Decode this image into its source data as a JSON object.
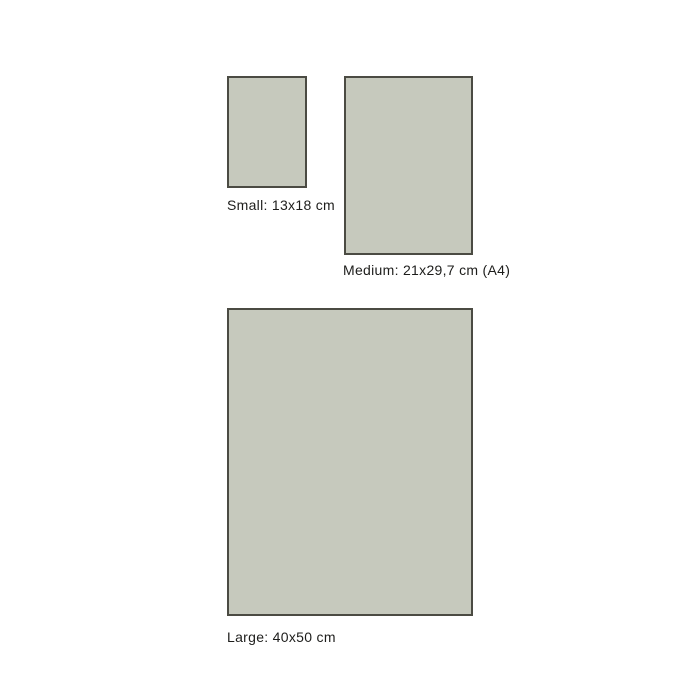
{
  "diagram": {
    "title": "print-size-guide",
    "colors": {
      "rect_fill": "#c6c9bd",
      "rect_border": "#4b4b43",
      "label_text": "#1d1d1b",
      "background": "#ffffff"
    },
    "sizes": [
      {
        "id": "small",
        "label": "Small: 13x18 cm",
        "width_cm": "13",
        "height_cm": "18"
      },
      {
        "id": "medium",
        "label": "Medium: 21x29,7 cm (A4)",
        "width_cm": "21",
        "height_cm": "29,7",
        "paper_standard": "A4"
      },
      {
        "id": "large",
        "label": "Large: 40x50 cm",
        "width_cm": "40",
        "height_cm": "50"
      }
    ]
  }
}
